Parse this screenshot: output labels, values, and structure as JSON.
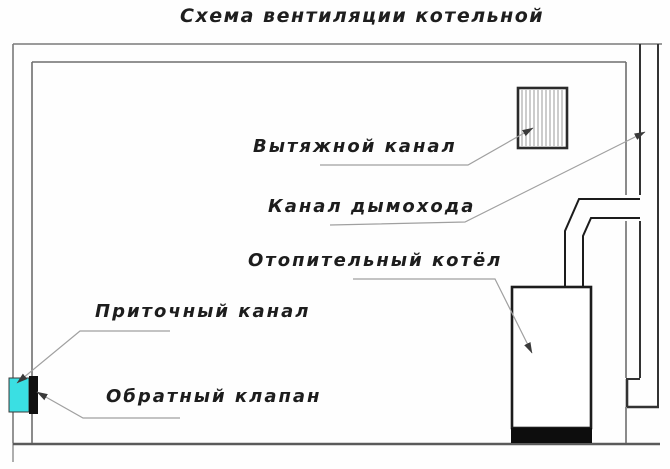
{
  "title": "Схема вентиляции котельной",
  "labels": {
    "exhaust": "Вытяжной канал",
    "chimney": "Канал дымохода",
    "boiler": "Отопительный котёл",
    "supply": "Приточный канал",
    "check_valve": "Обратный клапан"
  },
  "colors": {
    "valve_cyan": "#3ADFE3",
    "flap_black": "#101010",
    "ink": "#1c1c1c",
    "wall_gray": "#6e6e6e",
    "leader_gray": "#9e9e9e"
  }
}
